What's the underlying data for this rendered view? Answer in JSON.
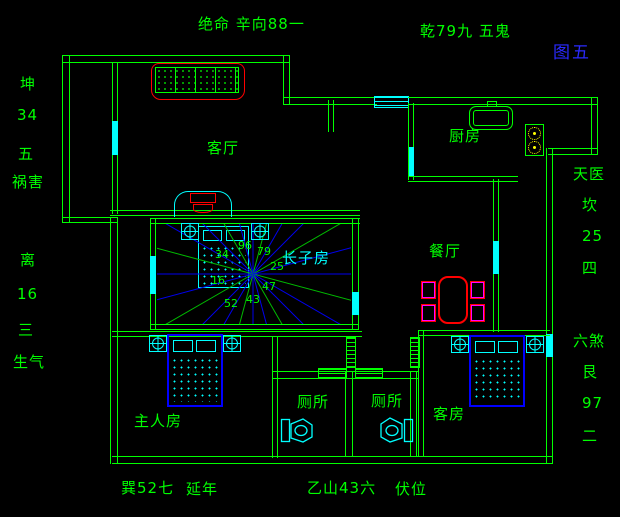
{
  "figure_label": {
    "text": "图五",
    "color": "#2a2aff"
  },
  "colors": {
    "background": "#000000",
    "wall_green": "#00ff00",
    "window_cyan": "#00ffff",
    "accent_red": "#ff0000",
    "chair_magenta": "#ff00ff",
    "furniture_blue": "#0000ff",
    "burner_yellow": "#ffff00",
    "figure_blue": "#2a2aff"
  },
  "fengshui_labels": [
    {
      "name": "label-jueming-xinxiang",
      "text": "绝命 辛向88一",
      "x": 198,
      "y": 16
    },
    {
      "name": "label-qian-wugui",
      "text": "乾79九 五鬼",
      "x": 420,
      "y": 23
    },
    {
      "name": "label-kun",
      "text": "坤",
      "x": 20,
      "y": 76
    },
    {
      "name": "label-kun-num",
      "text": "34",
      "x": 17,
      "y": 107
    },
    {
      "name": "label-kun-seq",
      "text": "五",
      "x": 18,
      "y": 146
    },
    {
      "name": "label-huohai",
      "text": "祸害",
      "x": 12,
      "y": 174
    },
    {
      "name": "label-li",
      "text": "离",
      "x": 20,
      "y": 252
    },
    {
      "name": "label-li-num",
      "text": "16",
      "x": 17,
      "y": 286
    },
    {
      "name": "label-li-seq",
      "text": "三",
      "x": 18,
      "y": 322
    },
    {
      "name": "label-shengqi",
      "text": "生气",
      "x": 13,
      "y": 354
    },
    {
      "name": "label-tianyi",
      "text": "天医",
      "x": 573,
      "y": 166
    },
    {
      "name": "label-kan",
      "text": "坎",
      "x": 582,
      "y": 197
    },
    {
      "name": "label-kan-num",
      "text": "25",
      "x": 582,
      "y": 228
    },
    {
      "name": "label-kan-seq",
      "text": "四",
      "x": 582,
      "y": 260
    },
    {
      "name": "label-liusha",
      "text": "六煞",
      "x": 573,
      "y": 333
    },
    {
      "name": "label-gen",
      "text": "艮",
      "x": 582,
      "y": 364
    },
    {
      "name": "label-gen-num",
      "text": "97",
      "x": 582,
      "y": 395
    },
    {
      "name": "label-gen-seq",
      "text": "二",
      "x": 582,
      "y": 428
    },
    {
      "name": "label-xun",
      "text": "巽52七",
      "x": 121,
      "y": 480
    },
    {
      "name": "label-yannian",
      "text": "延年",
      "x": 186,
      "y": 481
    },
    {
      "name": "label-yishan",
      "text": "乙山43六",
      "x": 307,
      "y": 480
    },
    {
      "name": "label-fuwei",
      "text": "伏位",
      "x": 395,
      "y": 481
    }
  ],
  "room_labels": [
    {
      "name": "room-living",
      "text": "客厅",
      "x": 207,
      "y": 140
    },
    {
      "name": "room-kitchen",
      "text": "厨房",
      "x": 449,
      "y": 128
    },
    {
      "name": "room-dining",
      "text": "餐厅",
      "x": 429,
      "y": 243
    },
    {
      "name": "room-eldest-son",
      "text": "长子房",
      "x": 282,
      "y": 250,
      "color": "#00ffff"
    },
    {
      "name": "room-master",
      "text": "主人房",
      "x": 134,
      "y": 413
    },
    {
      "name": "room-toilet-left",
      "text": "厕所",
      "x": 297,
      "y": 394
    },
    {
      "name": "room-toilet-right",
      "text": "厕所",
      "x": 371,
      "y": 393
    },
    {
      "name": "room-guest",
      "text": "客房",
      "x": 433,
      "y": 406
    }
  ],
  "compass": {
    "center_x": 253,
    "center_y": 274,
    "ray_count": 24,
    "angle_step": 15,
    "start_angle": 0,
    "ray_length": 160,
    "ray_color_blue": "#0000ee",
    "ray_color_green": "#00bb00",
    "numbers": [
      {
        "name": "compass-num-n",
        "text": "96",
        "x": 238,
        "y": 240
      },
      {
        "name": "compass-num-ne",
        "text": "79",
        "x": 257,
        "y": 246
      },
      {
        "name": "compass-num-e",
        "text": "25",
        "x": 270,
        "y": 261
      },
      {
        "name": "compass-num-se",
        "text": "47",
        "x": 262,
        "y": 281
      },
      {
        "name": "compass-num-s",
        "text": "43",
        "x": 246,
        "y": 294
      },
      {
        "name": "compass-num-sw",
        "text": "52",
        "x": 224,
        "y": 298
      },
      {
        "name": "compass-num-w",
        "text": "16",
        "x": 211,
        "y": 275
      },
      {
        "name": "compass-num-nw",
        "text": "34",
        "x": 215,
        "y": 249
      }
    ]
  }
}
